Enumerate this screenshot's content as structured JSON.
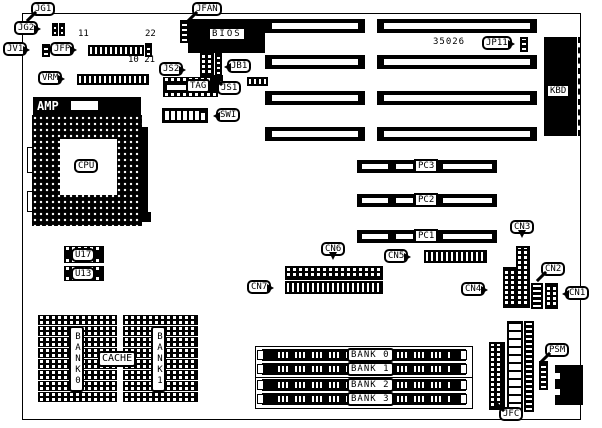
{
  "diagram": {
    "type": "motherboard-layout",
    "part_number": "35026",
    "colors": {
      "ink": "#000000",
      "paper": "#ffffff"
    },
    "labels": {
      "jg1": "JG1",
      "jg2": "JG2",
      "jv1": "JV1",
      "jfp": "JFP",
      "vrm": "VRM",
      "amp": "AMP",
      "cpu": "CPU",
      "u17": "U17",
      "u13": "U13",
      "jfan": "JFAN",
      "bios": "BIOS",
      "js2": "JS2",
      "jb1": "JB1",
      "tag": "TAG",
      "js1": "JS1",
      "swi": "SWI",
      "jp11": "JP11",
      "kbd": "KBD",
      "pc3": "PC3",
      "pc2": "PC2",
      "pc1": "PC1",
      "cn1": "CN1",
      "cn2": "CN2",
      "cn3": "CN3",
      "cn4": "CN4",
      "cn5": "CN5",
      "cn6": "CN6",
      "cn7": "CN7",
      "cache": "CACHE",
      "bank0": "BANK0",
      "bank1": "BANK1",
      "psm": "PSM",
      "jfc": "JFC"
    },
    "jfp_pins": {
      "p11": "11",
      "p22": "22",
      "p10_21": "10 21"
    },
    "memory_banks": [
      "BANK 0",
      "BANK 1",
      "BANK 2",
      "BANK 3"
    ]
  }
}
